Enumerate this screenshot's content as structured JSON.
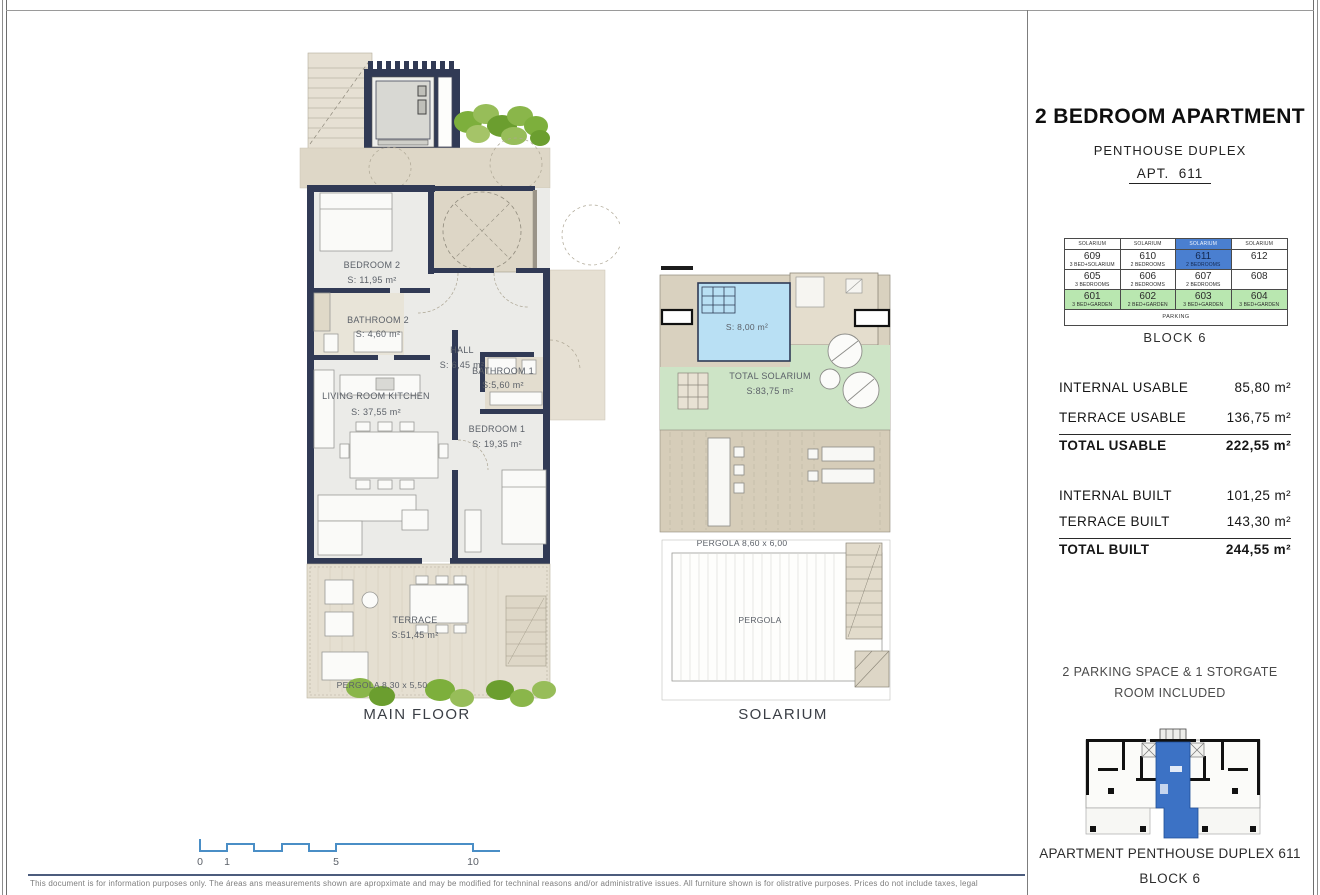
{
  "page": {
    "disclaimer": "This document is  for information purposes only. The áreas ans measurements shown are apropximate and may be  modified for techninal reasons and/or administrative issues. All furniture shown is for olistrative purposes. Prices do not include taxes, legal"
  },
  "header": {
    "title": "2 BEDROOM APARTMENT",
    "subtitle": "PENTHOUSE DUPLEX",
    "apt": "APT.  611"
  },
  "block_table": {
    "headers": [
      "SOLARIUM",
      "SOLARIUM",
      "SOLARIUM",
      "SOLARIUM"
    ],
    "cells": [
      {
        "num": "609",
        "type": "3 BED+SOLARIUM"
      },
      {
        "num": "610",
        "type": "2 BEDROOMS"
      },
      {
        "num": "611",
        "type": "2 BEDROOMS"
      },
      {
        "num": "612",
        "type": ""
      },
      {
        "num": "605",
        "type": "3 BEDROOMS"
      },
      {
        "num": "606",
        "type": "2 BEDROOMS"
      },
      {
        "num": "607",
        "type": "2 BEDROOMS"
      },
      {
        "num": "608",
        "type": ""
      },
      {
        "num": "601",
        "type": "3 BED+GARDEN"
      },
      {
        "num": "602",
        "type": "2 BED+GARDEN"
      },
      {
        "num": "603",
        "type": "3 BED+GARDEN"
      },
      {
        "num": "604",
        "type": "3 BED+GARDEN"
      }
    ],
    "parking": "PARKING",
    "caption": "BLOCK 6"
  },
  "areas": {
    "rows": [
      {
        "label": "INTERNAL  USABLE",
        "value": "85,80 m²"
      },
      {
        "label": "TERRACE USABLE",
        "value": "136,75 m²"
      },
      {
        "label": "TOTAL USABLE",
        "value": "222,55 m²"
      },
      {
        "label": "INTERNAL BUILT",
        "value": "101,25 m²"
      },
      {
        "label": "TERRACE  BUILT",
        "value": "143,30 m²"
      },
      {
        "label": "TOTAL  BUILT",
        "value": "244,55 m²"
      }
    ]
  },
  "parking_note": {
    "line1": "2 PARKING SPACE & 1 STORGATE",
    "line2": "ROOM INCLUDED"
  },
  "footer_right": {
    "line1": "APARTMENT PENTHOUSE DUPLEX 611",
    "line2": "BLOCK 6"
  },
  "main_plan": {
    "caption": "MAIN FLOOR",
    "bedroom2": {
      "name": "BEDROOM 2",
      "area": "S: 11,95 m²"
    },
    "bathroom2": {
      "name": "BATHROOM 2",
      "area": "S: 4,60 m²"
    },
    "hall": {
      "name": "HALL",
      "area": "S:  6,45 m²"
    },
    "living": {
      "name": "LIVING ROOM KITCHEN",
      "area": "S: 37,55 m²"
    },
    "bathroom1": {
      "name": "BATHROOM 1",
      "area": "S:5,60 m²"
    },
    "bedroom1": {
      "name": "BEDROOM 1",
      "area": "S: 19,35 m²"
    },
    "terrace": {
      "name": "TERRACE",
      "area": "S:51,45 m²"
    },
    "pergola": {
      "name": "PERGOLA 8,30 x 5,50"
    }
  },
  "solarium_plan": {
    "caption": "SOLARIUM",
    "pool_area": "S: 8,00 m²",
    "total_name": "TOTAL SOLARIUM",
    "total_area": "S:83,75 m²",
    "pergola_top": "PERGOLA 8,60 x 6,00",
    "pergola_bottom": "PERGOLA"
  },
  "scale_bar": {
    "t0": "0",
    "t1": "1",
    "t5": "5",
    "t10": "10"
  },
  "colors": {
    "wall_navy": "#313a55",
    "highlight_blue": "#4a7fd0",
    "garden_green": "#b9e7b0",
    "turf_green": "#cde4c6",
    "pool_blue": "#b9e0f4",
    "scale_blue": "#4a8ec6",
    "minimap_blue": "#3c72c5"
  }
}
